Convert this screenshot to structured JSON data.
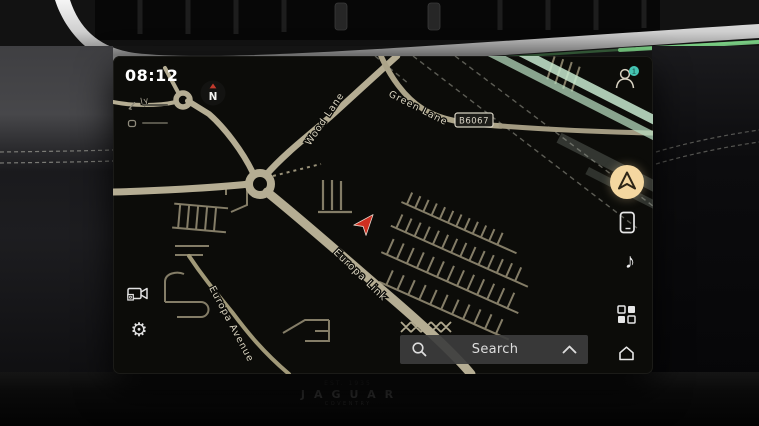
{
  "statusbar": {
    "time": "08:12"
  },
  "compass": {
    "label": "N"
  },
  "map_labels": {
    "wood_lane": "Wood Lane",
    "green_lane": "Green Lane",
    "road_badge": "B6067",
    "europa_link": "Europa Link",
    "europa_avenue": "Europa Avenue",
    "edge_partial": "ly"
  },
  "search": {
    "label": "Search"
  },
  "sidebar_right": {
    "profile_badge": "1"
  },
  "icons": {
    "music_glyph": "♪",
    "settings_glyph": "⚙"
  },
  "dash_plaque": {
    "est": "EST. 1935",
    "brand": "JAGUAR",
    "city": "COVENTRY"
  },
  "colors": {
    "accent_amber": "#f4d7a0",
    "badge_teal": "#45c4b2",
    "marker_red": "#ce2f20",
    "road_beige": "#b5ad93",
    "glare_mint": "#c8ead0"
  }
}
